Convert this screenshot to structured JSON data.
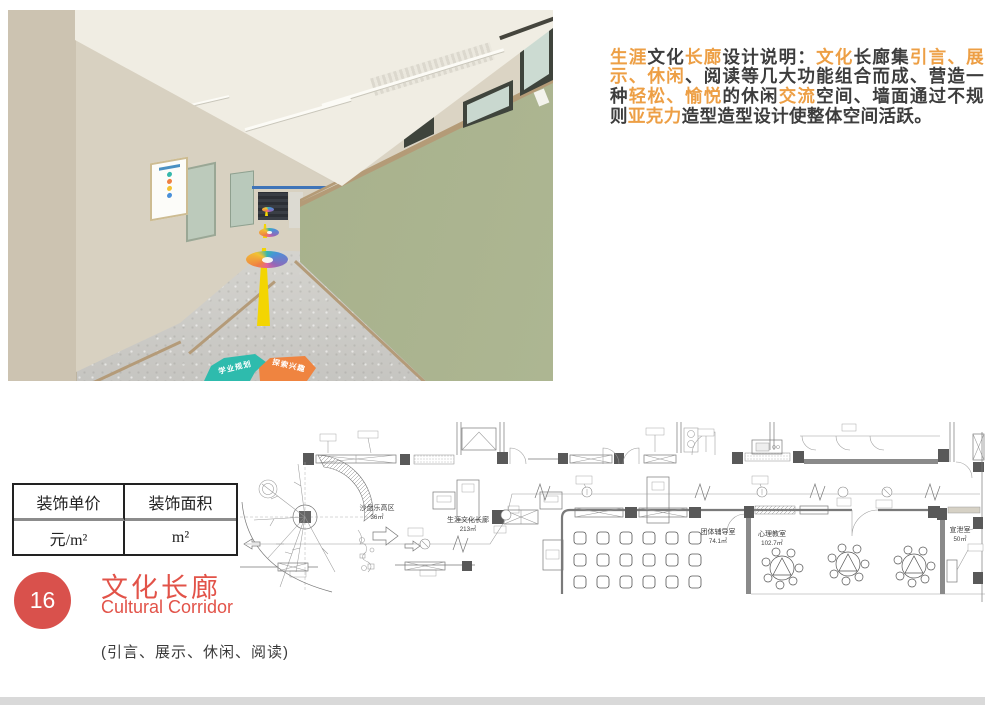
{
  "description": {
    "highlight_color": "#ed9f45",
    "text_color": "#3d3d3d",
    "segments": [
      {
        "text": "生涯",
        "hl": true
      },
      {
        "text": "文化",
        "hl": false
      },
      {
        "text": "长廊",
        "hl": true
      },
      {
        "text": "设计说明：",
        "hl": false
      },
      {
        "text": "文化",
        "hl": true
      },
      {
        "text": "长廊集",
        "hl": false
      },
      {
        "text": "引言、展示、休闲",
        "hl": true
      },
      {
        "text": "、阅读等几大功能组合而成、营造一种",
        "hl": false
      },
      {
        "text": "轻松、愉悦",
        "hl": true
      },
      {
        "text": "的休闲",
        "hl": false
      },
      {
        "text": "交流",
        "hl": true
      },
      {
        "text": "空间、墙面通过不规则",
        "hl": false
      },
      {
        "text": "亚克力",
        "hl": true
      },
      {
        "text": "造型造型设计使整体空间活跃。",
        "hl": false
      }
    ]
  },
  "photo": {
    "floor_sign_left": "学业规划",
    "floor_sign_right": "探索兴趣",
    "colors": {
      "green_wall": "#a9b28e",
      "beige_wall": "#d6cfbf",
      "yellow_line": "#f3d502",
      "teal_sign": "#2ebbad",
      "orange_sign": "#ef8440"
    }
  },
  "table": {
    "headers": [
      "装饰单价",
      "装饰面积"
    ],
    "values": [
      "元/m²",
      "m²"
    ]
  },
  "plan": {
    "labels": {
      "sandbox": "沙盘乐高区",
      "sandbox_area": "36㎡",
      "corridor": "生涯文化长廊",
      "corridor_area": "213㎡",
      "group": "团体辅导室",
      "group_area": "74.1㎡",
      "classroom": "心理教室",
      "classroom_area": "102.7㎡",
      "venting": "宣泄室",
      "venting_area": "50㎡"
    }
  },
  "footer": {
    "index": "16",
    "title": "文化长廊",
    "subtitle": "Cultural Corridor",
    "tags": "(引言、展示、休闲、阅读)",
    "accent": "#d9514c"
  }
}
